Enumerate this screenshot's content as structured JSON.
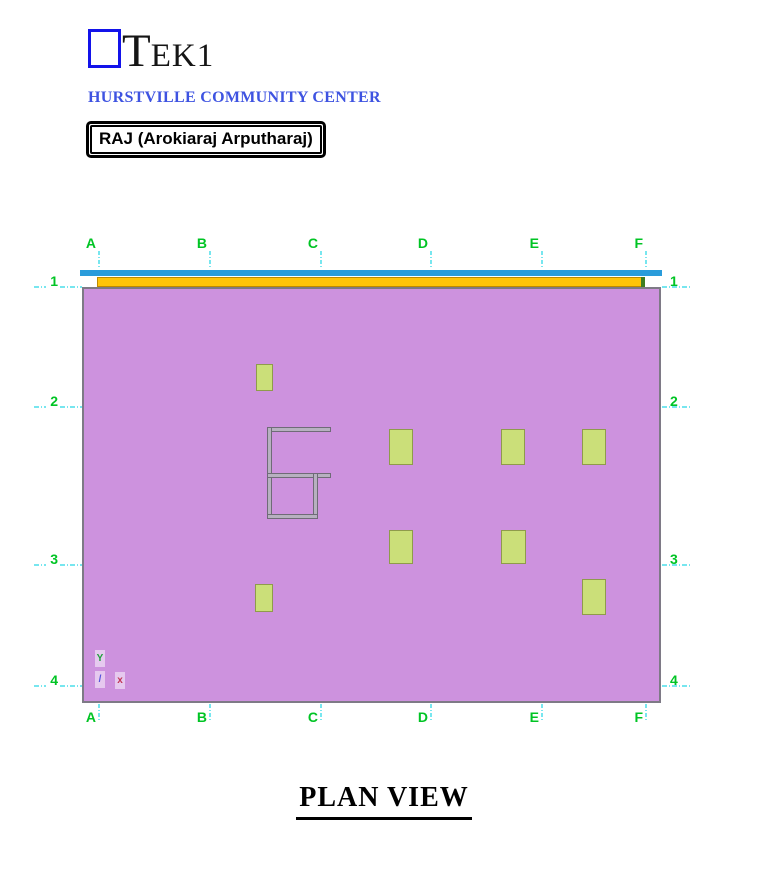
{
  "header": {
    "logo_t": "T",
    "logo_ek": "EK",
    "logo_one": "1",
    "subtitle": "HURSTVILLE COMMUNITY CENTER",
    "badge": "RAJ (Arokiaraj Arputharaj)"
  },
  "title": "PLAN VIEW",
  "plan": {
    "grid": {
      "columns": [
        {
          "label": "A",
          "x": 99
        },
        {
          "label": "B",
          "x": 210
        },
        {
          "label": "C",
          "x": 321
        },
        {
          "label": "D",
          "x": 431
        },
        {
          "label": "E",
          "x": 542
        },
        {
          "label": "F",
          "x": 646
        }
      ],
      "rows": [
        {
          "label": "1",
          "y": 287
        },
        {
          "label": "2",
          "y": 407
        },
        {
          "label": "3",
          "y": 565
        },
        {
          "label": "4",
          "y": 686
        }
      ]
    },
    "column_markers": [
      {
        "x": 256,
        "y": 364,
        "w": 17,
        "h": 27
      },
      {
        "x": 389,
        "y": 429,
        "w": 24,
        "h": 36
      },
      {
        "x": 501,
        "y": 429,
        "w": 24,
        "h": 36
      },
      {
        "x": 582,
        "y": 429,
        "w": 24,
        "h": 36
      },
      {
        "x": 389,
        "y": 530,
        "w": 24,
        "h": 34
      },
      {
        "x": 501,
        "y": 530,
        "w": 25,
        "h": 34
      },
      {
        "x": 582,
        "y": 579,
        "w": 24,
        "h": 36
      },
      {
        "x": 255,
        "y": 584,
        "w": 18,
        "h": 28
      }
    ],
    "wall_segments": [
      {
        "x": 267,
        "y": 427,
        "w": 64,
        "h": 5
      },
      {
        "x": 267,
        "y": 427,
        "w": 5,
        "h": 92
      },
      {
        "x": 267,
        "y": 473,
        "w": 64,
        "h": 5
      },
      {
        "x": 313,
        "y": 473,
        "w": 5,
        "h": 46
      },
      {
        "x": 267,
        "y": 514,
        "w": 51,
        "h": 5
      }
    ],
    "ucs_markers": [
      {
        "name": "ucs-y-axis-icon",
        "glyph": "Y",
        "x": 95,
        "y": 650,
        "color": "#1e9e3c"
      },
      {
        "name": "ucs-origin-icon",
        "glyph": "/",
        "x": 95,
        "y": 671,
        "color": "#5552dc"
      },
      {
        "name": "ucs-x-axis-icon",
        "glyph": "x",
        "x": 115,
        "y": 672,
        "color": "#c23455"
      }
    ],
    "colors": {
      "slab_fill": "#cd92de",
      "slab_border": "#7e7a86",
      "edge_beam_blue": "#2a9cdb",
      "beam_orange_fill": "#ffc40a",
      "beam_orange_border": "#bd8a00",
      "beam_end_green": "#3f7d22",
      "marker_fill": "#cbdf79",
      "marker_border": "#8f9b4b",
      "wall_fill": "#b7b0c0",
      "wall_border": "#6f6b77",
      "grid_label_green": "#00c424",
      "grid_line_cyan": "#77e6ef"
    }
  }
}
